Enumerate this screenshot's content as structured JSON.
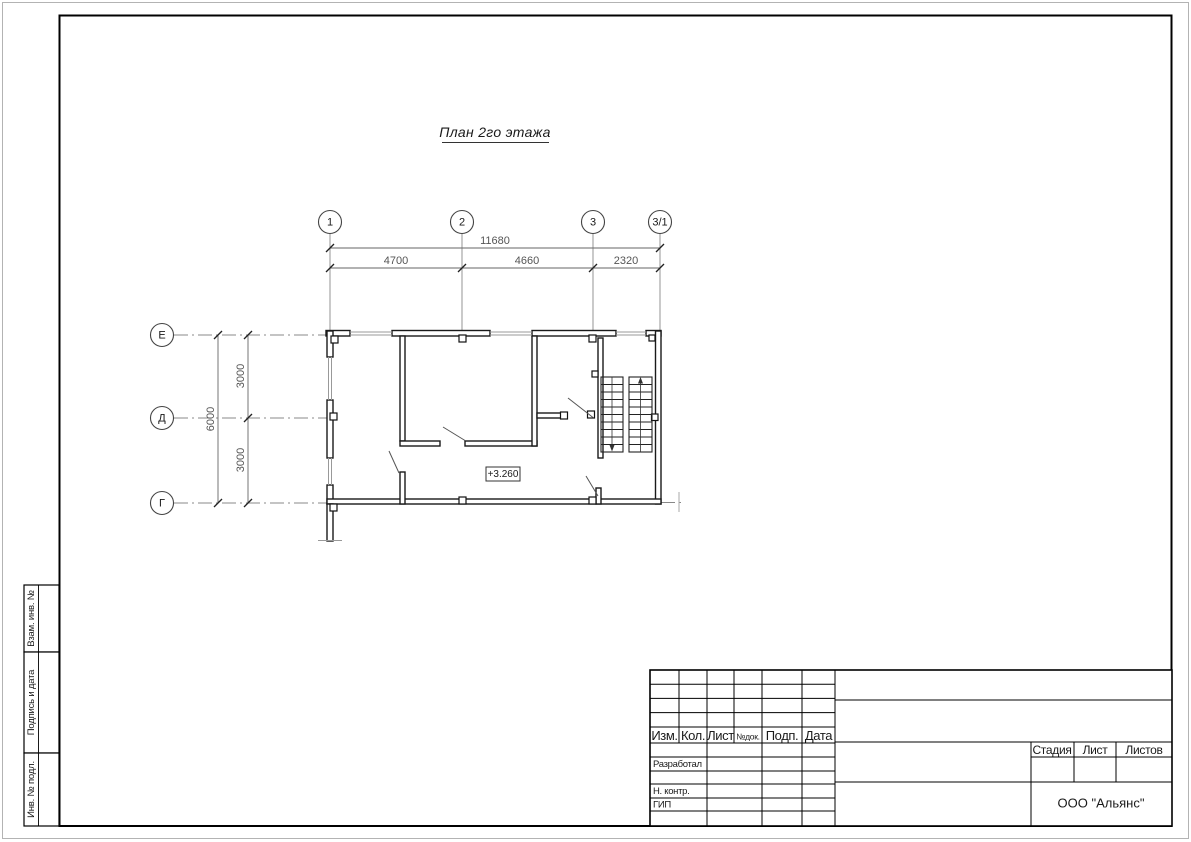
{
  "page": {
    "title": "План 2го этажа"
  },
  "plan": {
    "elevation_mark": "+3.260",
    "axes": {
      "top": [
        "1",
        "2",
        "3",
        "3/1"
      ],
      "left": [
        "Е",
        "Д",
        "Г"
      ]
    },
    "dimensions": {
      "horizontal_total": "11680",
      "horizontal_segments": [
        "4700",
        "4660",
        "2320"
      ],
      "vertical_total": "6000",
      "vertical_segments": [
        "3000",
        "3000"
      ]
    }
  },
  "title_block": {
    "header_cells": [
      "Изм.",
      "Кол.",
      "Лист",
      "№док.",
      "Подп.",
      "Дата"
    ],
    "roles": [
      "Разработал",
      "Н. контр.",
      "ГИП"
    ],
    "stage_header": [
      "Стадия",
      "Лист",
      "Листов"
    ],
    "company": "ООО \"Альянс\""
  },
  "side_labels": [
    "Взам. инв. №",
    "Подпись и дата",
    "Инв. № подл."
  ],
  "colors": {
    "wall_line": "#1a1a1a",
    "thin_line": "#999999",
    "dim_line": "#666666",
    "axis_line": "#888888"
  }
}
